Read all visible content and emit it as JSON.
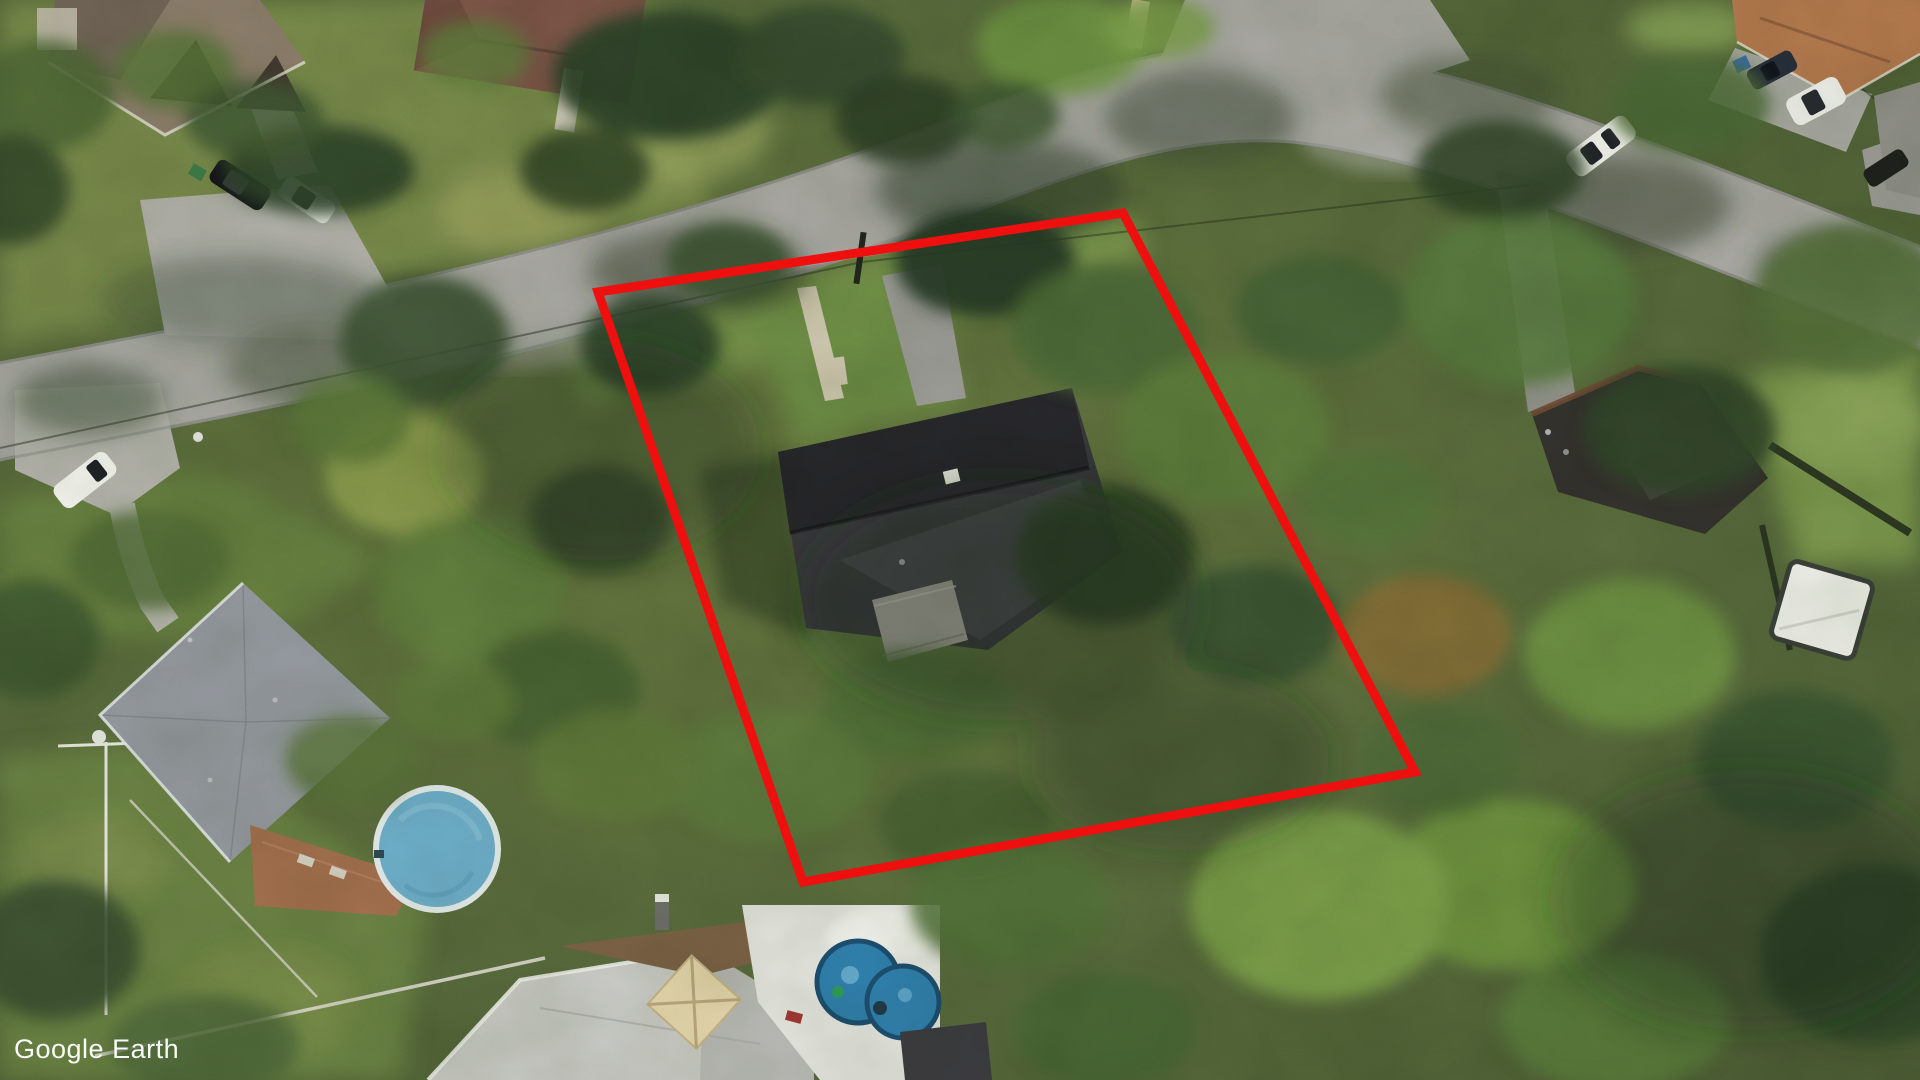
{
  "watermark": {
    "text": "Google Earth"
  },
  "boundary": {
    "label": "property-boundary-outline",
    "color": "#ee0f0f",
    "stroke_width": 9,
    "points": "598,292 1123,213 1415,772 803,882"
  },
  "palette": {
    "ground": "#5c6b3e",
    "road": "#a9a8a4",
    "concrete_walk": "#d2cab2",
    "grass_bright": "#7d9f4a",
    "tree_dark": "#2e4226"
  },
  "objects": {
    "houses": [
      {
        "id": "house-top-left",
        "roof_color": "#8d7d6c"
      },
      {
        "id": "house-top-center",
        "roof_color": "#7e564a"
      },
      {
        "id": "house-top-right",
        "roof_color": "#b5794e"
      },
      {
        "id": "house-right-edge",
        "roof_color": "#8e8e88"
      },
      {
        "id": "house-subject-center",
        "roof_color": "#3a3a3e"
      },
      {
        "id": "house-left-gray",
        "roof_color": "#969aa2"
      },
      {
        "id": "house-right-dark",
        "roof_color": "#34322e"
      },
      {
        "id": "house-bottom-white",
        "roof_color": "#cbcbc8"
      }
    ],
    "pools": [
      {
        "id": "round-above-ground-pool",
        "color": "#6fb0cf"
      },
      {
        "id": "kiddie-pool",
        "color": "#2f7fae"
      }
    ],
    "cars": [
      {
        "id": "car-black-driveway",
        "color": "#16161a"
      },
      {
        "id": "car-white-driveway",
        "color": "#f4f4f1"
      },
      {
        "id": "car-white-left-pad",
        "color": "#f7f7f4"
      },
      {
        "id": "car-white-on-road",
        "color": "#f8f8f5"
      },
      {
        "id": "car-white-top-right",
        "color": "#f2f2ef"
      },
      {
        "id": "car-dark-top-right",
        "color": "#262e3a"
      },
      {
        "id": "car-dark-right-edge",
        "color": "#1e201b"
      }
    ],
    "gazebo": {
      "id": "white-gazebo",
      "color": "#f2f2ee"
    },
    "umbrella": {
      "id": "patio-umbrella",
      "color": "#ead9b0"
    },
    "deck": {
      "id": "wood-deck",
      "color": "#a5704f"
    }
  }
}
